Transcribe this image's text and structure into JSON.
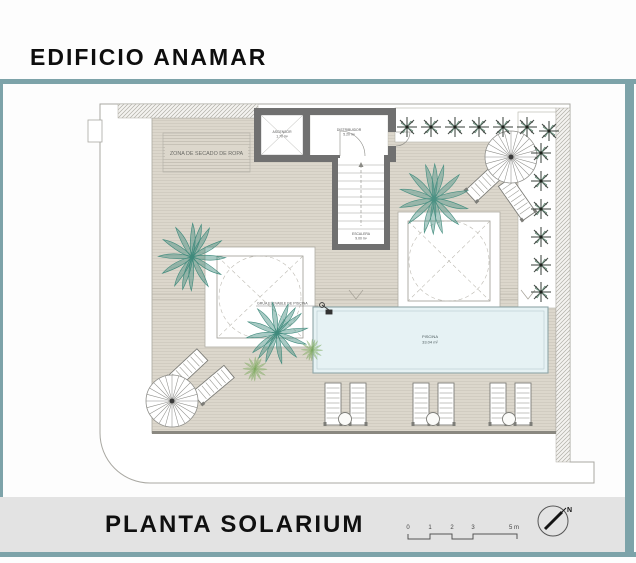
{
  "header": {
    "title": "EDIFICIO ANAMAR"
  },
  "plan": {
    "labels": {
      "drying_zone": "ZONA DE SECADO DE ROPA",
      "elevator_name": "ASCENSOR",
      "elevator_area": "1.70 m²",
      "hall_name": "DISTRIBUIDOR",
      "hall_area": "5.20 m²",
      "stair_name": "ESCALERA",
      "stair_area": "9.00 m²",
      "pool_name": "PISCINA",
      "pool_area": "33.04 m²",
      "pool_lift": "GRUA ELEVABLE DE PISCINA"
    },
    "colors": {
      "frame_teal": "#7da3a9",
      "terrace_beige": "#dcd7cc",
      "pool_blue": "#e6f2f4",
      "wall_gray": "#707070",
      "palm_green": "#3f8a7c",
      "bush_dark": "#474f49",
      "footer_band": "#e3e3e3"
    }
  },
  "footer": {
    "title": "PLANTA SOLARIUM",
    "scale_ticks": [
      "0",
      "1",
      "2",
      "3",
      "5 m"
    ],
    "north": "N"
  }
}
